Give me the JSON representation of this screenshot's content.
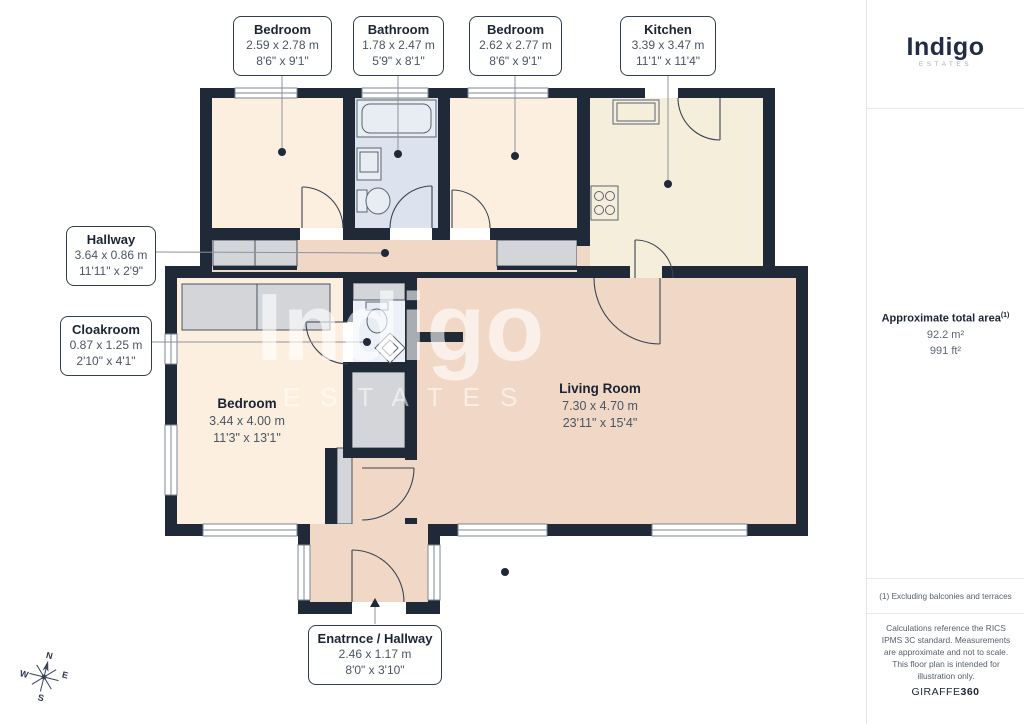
{
  "floorplan": {
    "boxed_labels": [
      {
        "title": "Bedroom",
        "metric": "2.59 x 2.78 m",
        "imperial": "8'6\" x 9'1\""
      },
      {
        "title": "Bathroom",
        "metric": "1.78 x 2.47 m",
        "imperial": "5'9\" x 8'1\""
      },
      {
        "title": "Bedroom",
        "metric": "2.62 x 2.77 m",
        "imperial": "8'6\" x 9'1\""
      },
      {
        "title": "Kitchen",
        "metric": "3.39 x 3.47 m",
        "imperial": "11'1\" x 11'4\""
      },
      {
        "title": "Hallway",
        "metric": "3.64 x 0.86 m",
        "imperial": "11'11\" x 2'9\""
      },
      {
        "title": "Cloakroom",
        "metric": "0.87 x 1.25 m",
        "imperial": "2'10\" x 4'1\""
      },
      {
        "title": "Enatrnce / Hallway",
        "metric": "2.46 x 1.17 m",
        "imperial": "8'0\" x 3'10\""
      }
    ],
    "room_labels": [
      {
        "title": "Bedroom",
        "metric": "3.44 x 4.00 m",
        "imperial": "11'3\" x 13'1\""
      },
      {
        "title": "Living Room",
        "metric": "7.30 x 4.70 m",
        "imperial": "23'11\" x 15'4\""
      }
    ],
    "watermark": {
      "line1": "Indigo",
      "line2": "ESTATES"
    },
    "compass": {
      "n": "N",
      "e": "E",
      "s": "S",
      "w": "W"
    }
  },
  "sidebar": {
    "logo": {
      "name": "Indigo",
      "tagline": "ESTATES"
    },
    "area": {
      "title": "Approximate total area",
      "sup": "(1)",
      "metric": "92.2 m²",
      "imperial": "991 ft²"
    },
    "footnote": "(1) Excluding balconies and terraces",
    "disclaimer": "Calculations reference the RICS IPMS 3C standard. Measurements are approximate and not to scale. This floor plan is intended for illustration only.",
    "brand": {
      "name": "GIRAFFE",
      "suffix": "360"
    }
  },
  "colors": {
    "wall": "#1f2937",
    "bedroom": "#fcefdf",
    "living": "#f1d8c6",
    "kitchen": "#f4eeda",
    "bathroom": "#dde3ee",
    "cloakroom": "#edf0f6",
    "closet": "#d3d5d9",
    "accent": "#232c47"
  }
}
